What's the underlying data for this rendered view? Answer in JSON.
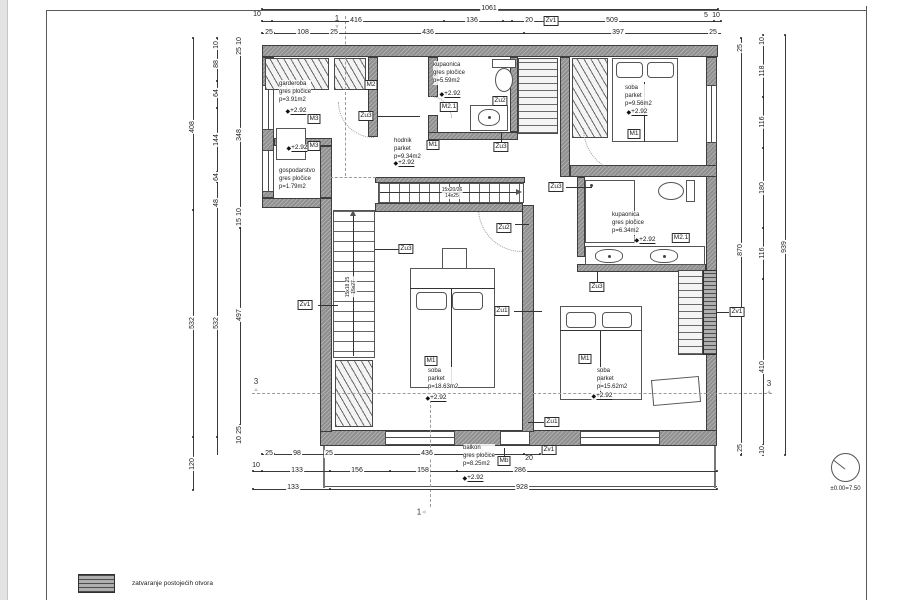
{
  "legend": {
    "text": "zatvaranje postojećih otvora"
  },
  "level_symbol": {
    "label": "±0.00=7.50"
  },
  "level_value": "+2.92",
  "rooms": [
    {
      "x": 279,
      "y": 80,
      "lines": [
        "garderoba",
        "gres pločice",
        "p=3.91m2"
      ]
    },
    {
      "x": 279,
      "y": 167,
      "lines": [
        "gospodarstvo",
        "gres pločice",
        "p=1.79m2"
      ]
    },
    {
      "x": 394,
      "y": 137,
      "lines": [
        "hodnik",
        "parket",
        "p=9.34m2"
      ]
    },
    {
      "x": 433,
      "y": 61,
      "lines": [
        "kupaonica",
        "gres pločice",
        "p=5.59m2"
      ]
    },
    {
      "x": 625,
      "y": 84,
      "lines": [
        "soba",
        "parket",
        "p=9.56m2"
      ]
    },
    {
      "x": 612,
      "y": 211,
      "lines": [
        "kupaonica",
        "gres pločice",
        "p=6.34m2"
      ]
    },
    {
      "x": 428,
      "y": 367,
      "lines": [
        "soba",
        "parket",
        "p=18.63m2"
      ]
    },
    {
      "x": 597,
      "y": 367,
      "lines": [
        "soba",
        "parket",
        "p=15.62m2"
      ]
    },
    {
      "x": 463,
      "y": 444,
      "lines": [
        "balkon",
        "gres pločice",
        "p=8.25m2"
      ]
    }
  ],
  "tags": [
    {
      "t": "M2",
      "x": 371,
      "y": 85
    },
    {
      "t": "M3",
      "x": 314,
      "y": 119
    },
    {
      "t": "M3",
      "x": 314,
      "y": 146
    },
    {
      "t": "M2.1",
      "x": 449,
      "y": 107
    },
    {
      "t": "Zu2",
      "x": 500,
      "y": 101
    },
    {
      "t": "M1",
      "x": 433,
      "y": 145
    },
    {
      "t": "Zu3",
      "x": 366,
      "y": 116
    },
    {
      "t": "Zu3",
      "x": 501,
      "y": 147
    },
    {
      "t": "M1",
      "x": 634,
      "y": 134
    },
    {
      "t": "Zu3",
      "x": 556,
      "y": 187
    },
    {
      "t": "M2.1",
      "x": 681,
      "y": 238
    },
    {
      "t": "Zu3",
      "x": 406,
      "y": 249
    },
    {
      "t": "Zu2",
      "x": 504,
      "y": 228
    },
    {
      "t": "Zu3",
      "x": 597,
      "y": 287
    },
    {
      "t": "Zu1",
      "x": 502,
      "y": 311
    },
    {
      "t": "Zv1",
      "x": 305,
      "y": 305
    },
    {
      "t": "Zv1",
      "x": 737,
      "y": 312
    },
    {
      "t": "M1",
      "x": 431,
      "y": 361
    },
    {
      "t": "M1",
      "x": 585,
      "y": 359
    },
    {
      "t": "Zu1",
      "x": 552,
      "y": 422
    },
    {
      "t": "Zv1",
      "x": 551,
      "y": 21
    },
    {
      "t": "Zv1",
      "x": 549,
      "y": 450
    },
    {
      "t": "Mb",
      "x": 504,
      "y": 461
    }
  ],
  "levels": [
    {
      "x": 296,
      "y": 111
    },
    {
      "x": 297,
      "y": 148
    },
    {
      "x": 404,
      "y": 163
    },
    {
      "x": 450,
      "y": 94
    },
    {
      "x": 637,
      "y": 112
    },
    {
      "x": 645,
      "y": 240
    },
    {
      "x": 436,
      "y": 398
    },
    {
      "x": 602,
      "y": 396
    },
    {
      "x": 473,
      "y": 478
    }
  ],
  "dims": [
    {
      "t": "1061",
      "x": 489,
      "y": 9
    },
    {
      "t": "10",
      "x": 257,
      "y": 15
    },
    {
      "t": "416",
      "x": 356,
      "y": 21
    },
    {
      "t": "136",
      "x": 472,
      "y": 21
    },
    {
      "t": "20",
      "x": 529,
      "y": 21
    },
    {
      "t": "509",
      "x": 612,
      "y": 21
    },
    {
      "t": "5",
      "x": 706,
      "y": 16
    },
    {
      "t": "10",
      "x": 716,
      "y": 16
    },
    {
      "t": "25",
      "x": 269,
      "y": 33
    },
    {
      "t": "108",
      "x": 303,
      "y": 33
    },
    {
      "t": "25",
      "x": 334,
      "y": 33
    },
    {
      "t": "436",
      "x": 428,
      "y": 33
    },
    {
      "t": "397",
      "x": 618,
      "y": 33
    },
    {
      "t": "25",
      "x": 713,
      "y": 33
    },
    {
      "t": "408",
      "x": 193,
      "y": 127,
      "rot": 1
    },
    {
      "t": "532",
      "x": 193,
      "y": 323,
      "rot": 1
    },
    {
      "t": "120",
      "x": 193,
      "y": 464,
      "rot": 1
    },
    {
      "t": "10",
      "x": 217,
      "y": 45,
      "rot": 1
    },
    {
      "t": "88",
      "x": 217,
      "y": 64,
      "rot": 1
    },
    {
      "t": "64",
      "x": 217,
      "y": 93,
      "rot": 1
    },
    {
      "t": "144",
      "x": 217,
      "y": 140,
      "rot": 1
    },
    {
      "t": "64",
      "x": 217,
      "y": 177,
      "rot": 1
    },
    {
      "t": "48",
      "x": 217,
      "y": 203,
      "rot": 1
    },
    {
      "t": "532",
      "x": 217,
      "y": 323,
      "rot": 1
    },
    {
      "t": "10",
      "x": 240,
      "y": 41,
      "rot": 1
    },
    {
      "t": "25",
      "x": 240,
      "y": 51,
      "rot": 1
    },
    {
      "t": "348",
      "x": 240,
      "y": 135,
      "rot": 1
    },
    {
      "t": "10",
      "x": 240,
      "y": 212,
      "rot": 1
    },
    {
      "t": "15",
      "x": 240,
      "y": 222,
      "rot": 1
    },
    {
      "t": "497",
      "x": 240,
      "y": 315,
      "rot": 1
    },
    {
      "t": "25",
      "x": 240,
      "y": 430,
      "rot": 1
    },
    {
      "t": "10",
      "x": 240,
      "y": 440,
      "rot": 1
    },
    {
      "t": "25",
      "x": 741,
      "y": 48,
      "rot": 1
    },
    {
      "t": "870",
      "x": 741,
      "y": 250,
      "rot": 1
    },
    {
      "t": "25",
      "x": 741,
      "y": 448,
      "rot": 1
    },
    {
      "t": "10",
      "x": 763,
      "y": 41,
      "rot": 1
    },
    {
      "t": "118",
      "x": 763,
      "y": 71,
      "rot": 1
    },
    {
      "t": "116",
      "x": 763,
      "y": 122,
      "rot": 1
    },
    {
      "t": "180",
      "x": 763,
      "y": 188,
      "rot": 1
    },
    {
      "t": "116",
      "x": 763,
      "y": 253,
      "rot": 1
    },
    {
      "t": "410",
      "x": 763,
      "y": 367,
      "rot": 1
    },
    {
      "t": "10",
      "x": 763,
      "y": 450,
      "rot": 1
    },
    {
      "t": "939",
      "x": 785,
      "y": 247,
      "rot": 1
    },
    {
      "t": "25",
      "x": 269,
      "y": 454
    },
    {
      "t": "98",
      "x": 297,
      "y": 454
    },
    {
      "t": "25",
      "x": 329,
      "y": 454
    },
    {
      "t": "436",
      "x": 427,
      "y": 454
    },
    {
      "t": "20",
      "x": 529,
      "y": 459
    },
    {
      "t": "10",
      "x": 256,
      "y": 466
    },
    {
      "t": "133",
      "x": 297,
      "y": 471
    },
    {
      "t": "156",
      "x": 357,
      "y": 471
    },
    {
      "t": "158",
      "x": 423,
      "y": 471
    },
    {
      "t": "286",
      "x": 520,
      "y": 471
    },
    {
      "t": "133",
      "x": 293,
      "y": 488
    },
    {
      "t": "928",
      "x": 522,
      "y": 488
    }
  ],
  "dim_lines": [
    {
      "x": 262,
      "y": 9,
      "len": 456,
      "dir": "h",
      "ticks": [
        0,
        456
      ]
    },
    {
      "x": 262,
      "y": 21,
      "len": 459,
      "dir": "h",
      "ticks": [
        0,
        10,
        182,
        241,
        250,
        452,
        459
      ]
    },
    {
      "x": 262,
      "y": 33,
      "len": 459,
      "dir": "h",
      "ticks": [
        0,
        12,
        70,
        262,
        448,
        455
      ]
    },
    {
      "x": 193,
      "y": 38,
      "len": 452,
      "dir": "v",
      "ticks": [
        0,
        172,
        399,
        452
      ]
    },
    {
      "x": 217,
      "y": 38,
      "len": 417,
      "dir": "v",
      "ticks": [
        0,
        7,
        43,
        70,
        134,
        144,
        169,
        399
      ]
    },
    {
      "x": 240,
      "y": 38,
      "len": 402,
      "dir": "v",
      "ticks": [
        0,
        6,
        14,
        170,
        178,
        190,
        387,
        394,
        402
      ]
    },
    {
      "x": 741,
      "y": 38,
      "len": 417,
      "dir": "v",
      "ticks": [
        0,
        10,
        410,
        417
      ]
    },
    {
      "x": 763,
      "y": 35,
      "len": 420,
      "dir": "v",
      "ticks": [
        0,
        10,
        62,
        113,
        193,
        244,
        410,
        420
      ]
    },
    {
      "x": 785,
      "y": 35,
      "len": 420,
      "dir": "v",
      "ticks": [
        0,
        420
      ]
    },
    {
      "x": 262,
      "y": 454,
      "len": 278,
      "dir": "h",
      "ticks": [
        0,
        12,
        68,
        262,
        278
      ]
    },
    {
      "x": 253,
      "y": 471,
      "len": 464,
      "dir": "h",
      "ticks": [
        0,
        9,
        77,
        137,
        204,
        464
      ]
    },
    {
      "x": 253,
      "y": 489,
      "len": 464,
      "dir": "h",
      "ticks": [
        0,
        77,
        464
      ]
    }
  ],
  "sections": [
    {
      "t": "1",
      "x": 337,
      "y": 22,
      "g": "▿",
      "layout": "col"
    },
    {
      "t": "1",
      "x": 421,
      "y": 512,
      "g": "◃",
      "layout": "row"
    },
    {
      "t": "3",
      "x": 256,
      "y": 385,
      "g": "▵",
      "layout": "col"
    },
    {
      "t": "3",
      "x": 769,
      "y": 387,
      "g": "▵",
      "layout": "col"
    }
  ],
  "stair_notes": [
    {
      "x": 452,
      "y": 193,
      "rot": 0,
      "lines": [
        "15x20/26",
        "14x25"
      ]
    },
    {
      "x": 351,
      "y": 287,
      "rot": 1,
      "lines": [
        "15x18.25",
        "15x27"
      ]
    }
  ]
}
